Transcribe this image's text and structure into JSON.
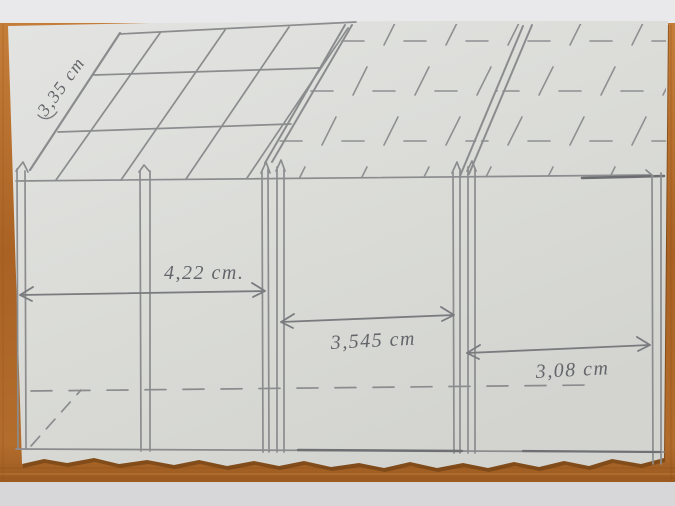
{
  "photo": {
    "scene": "hand-drawn pencil sketch of a building facade photographed on a wooden table",
    "colors": {
      "background_top": "#e9e9eb",
      "background_bottom": "#d7d7d9",
      "wood_table": "#ad6526",
      "paper": "#dcddd9",
      "pencil": "#8b8c8e",
      "handwriting": "#63656a"
    }
  },
  "sketch": {
    "labels": {
      "roof": "3,35 cm",
      "left_bay": "4,22 cm.",
      "middle_bay": "3,545 cm",
      "right_bay": "3,08 cm"
    },
    "measurements_cm": {
      "roof": 3.35,
      "left_bay": 4.22,
      "middle_bay": 3.545,
      "right_bay": 3.08
    }
  }
}
